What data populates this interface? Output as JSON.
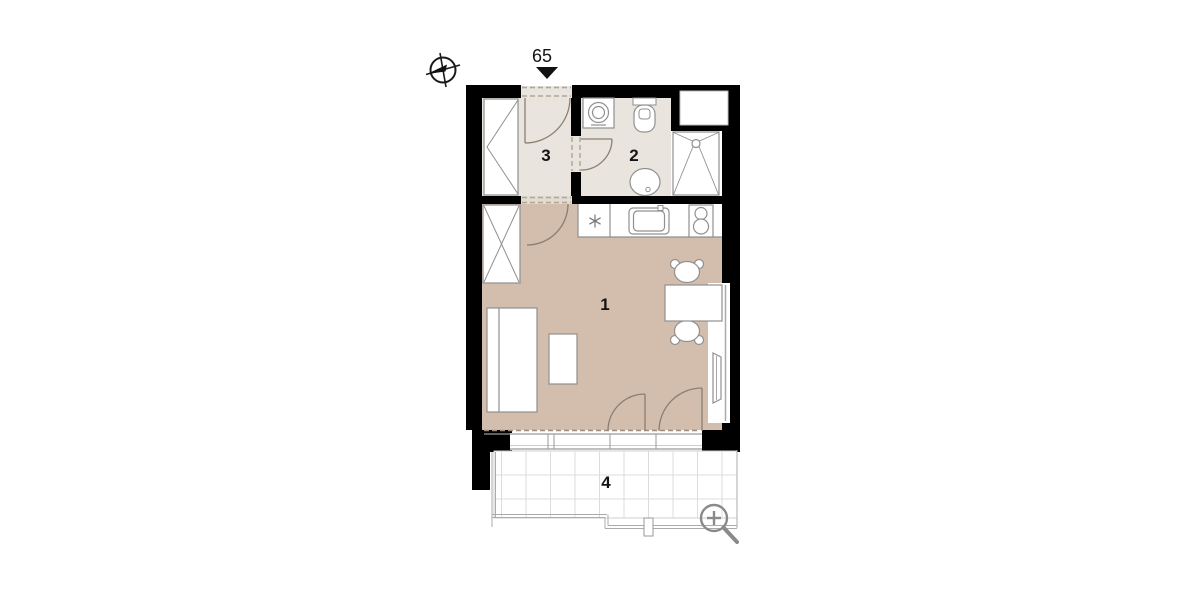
{
  "plan": {
    "entrance": {
      "label": "65"
    },
    "rooms": [
      {
        "label": "1"
      },
      {
        "label": "2"
      },
      {
        "label": "3"
      },
      {
        "label": "4"
      }
    ]
  },
  "icons": {
    "north_arrow": "compass-crosshair-circle",
    "zoom": "magnifier-with-plus",
    "entrance_marker": "down-triangle"
  },
  "colors": {
    "wall": "#000000",
    "living_room_floor": "#d3bdac",
    "hall_bath_floor": "#e9e5de",
    "furniture_stroke": "#909090",
    "door_stroke": "#8a7f72",
    "balcony_grid": "#dcdcdc",
    "railing": "#ababab",
    "zoom_icon": "#8a8a8a",
    "text": "#141414"
  }
}
